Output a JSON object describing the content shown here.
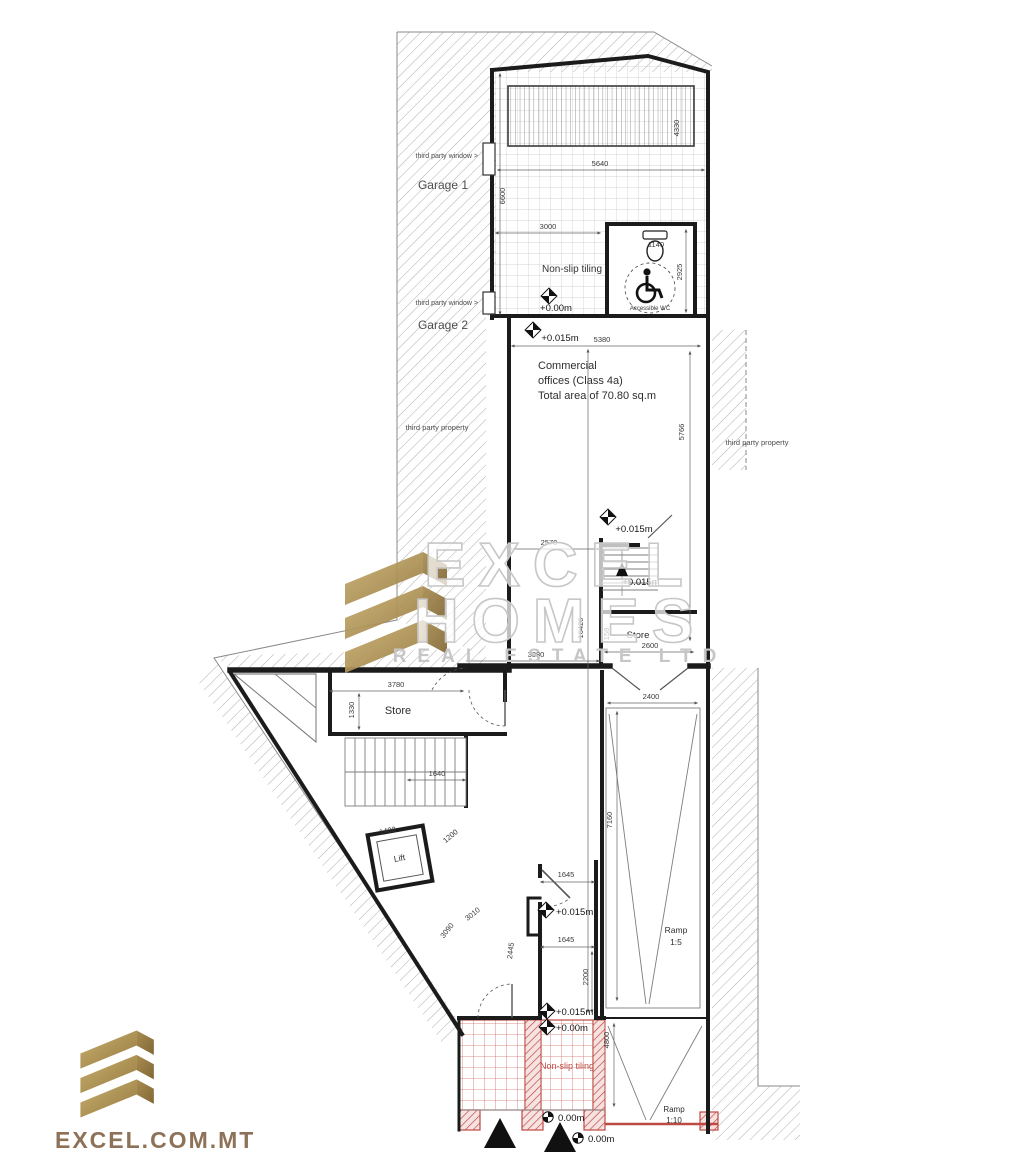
{
  "branding": {
    "watermark": {
      "line1": "EXCEL",
      "line2": "HOMES",
      "line3": "REAL ESTATE LTD"
    },
    "footer_site": "EXCEL.COM.MT"
  },
  "labels": {
    "third_party_window_1": "third party window >",
    "third_party_window_2": "third party window >",
    "garage_1": "Garage 1",
    "garage_2": "Garage 2",
    "third_party_property_left": "third party property",
    "third_party_property_right": "third party property",
    "non_slip_tiling_top": "Non-slip tiling",
    "accessible_wc": "Accessible WC",
    "commercial_line1": "Commercial",
    "commercial_line2": "offices (Class 4a)",
    "commercial_line3": "Total area of 70.80 sq.m",
    "store_mid": "Store",
    "store_left": "Store",
    "lift": "Lift",
    "ramp_upper_word": "Ramp",
    "ramp_upper_slope": "1:5",
    "ramp_lower_word": "Ramp",
    "ramp_lower_slope": "1:10",
    "non_slip_tiling_bottom": "Non-slip tiling"
  },
  "levels": {
    "top_landing": "+0.00m",
    "entry_office": "+0.015m",
    "office_mid": "+0.015m",
    "stair_mid": "+0.015m",
    "corridor": "+0.015m",
    "entrance_inner": "+0.015m",
    "entrance_outer": "+0.00m",
    "street_1": "0.00m",
    "street_2": "0.00m"
  },
  "dims": {
    "top_width": "5640",
    "louvre_height": "4330",
    "garage_depth": "6600",
    "inner_width": "3000",
    "wc_fixture": "1140",
    "wc_height": "2925",
    "entry_width": "5380",
    "office_height": "5766",
    "office_notch": "2570",
    "total_depth": "16420",
    "store_step": "158",
    "store_mid_width": "2600",
    "office_width": "3380",
    "store_left_width": "3780",
    "store_left_height": "1330",
    "stair_width": "1640",
    "lift_width": "1400",
    "lift_clear": "1200",
    "room_diag1": "3010",
    "room_diag2": "3090",
    "room_side": "2445",
    "corridor_top": "1645",
    "corridor_bottom": "1645",
    "corridor_height": "2200",
    "ramp_width": "2400",
    "ramp_length": "7160",
    "entrance_depth": "4800"
  },
  "colors": {
    "accent_red": "#bf4943",
    "brand_gold": "#a98a4f",
    "brand_text": "#8d7258",
    "wall": "#1b1b1b",
    "hatch": "#a0a0a0",
    "grid": "#c6c6c6",
    "watermark": "#c7c7c7",
    "dim_text": "#3a3a3a"
  }
}
